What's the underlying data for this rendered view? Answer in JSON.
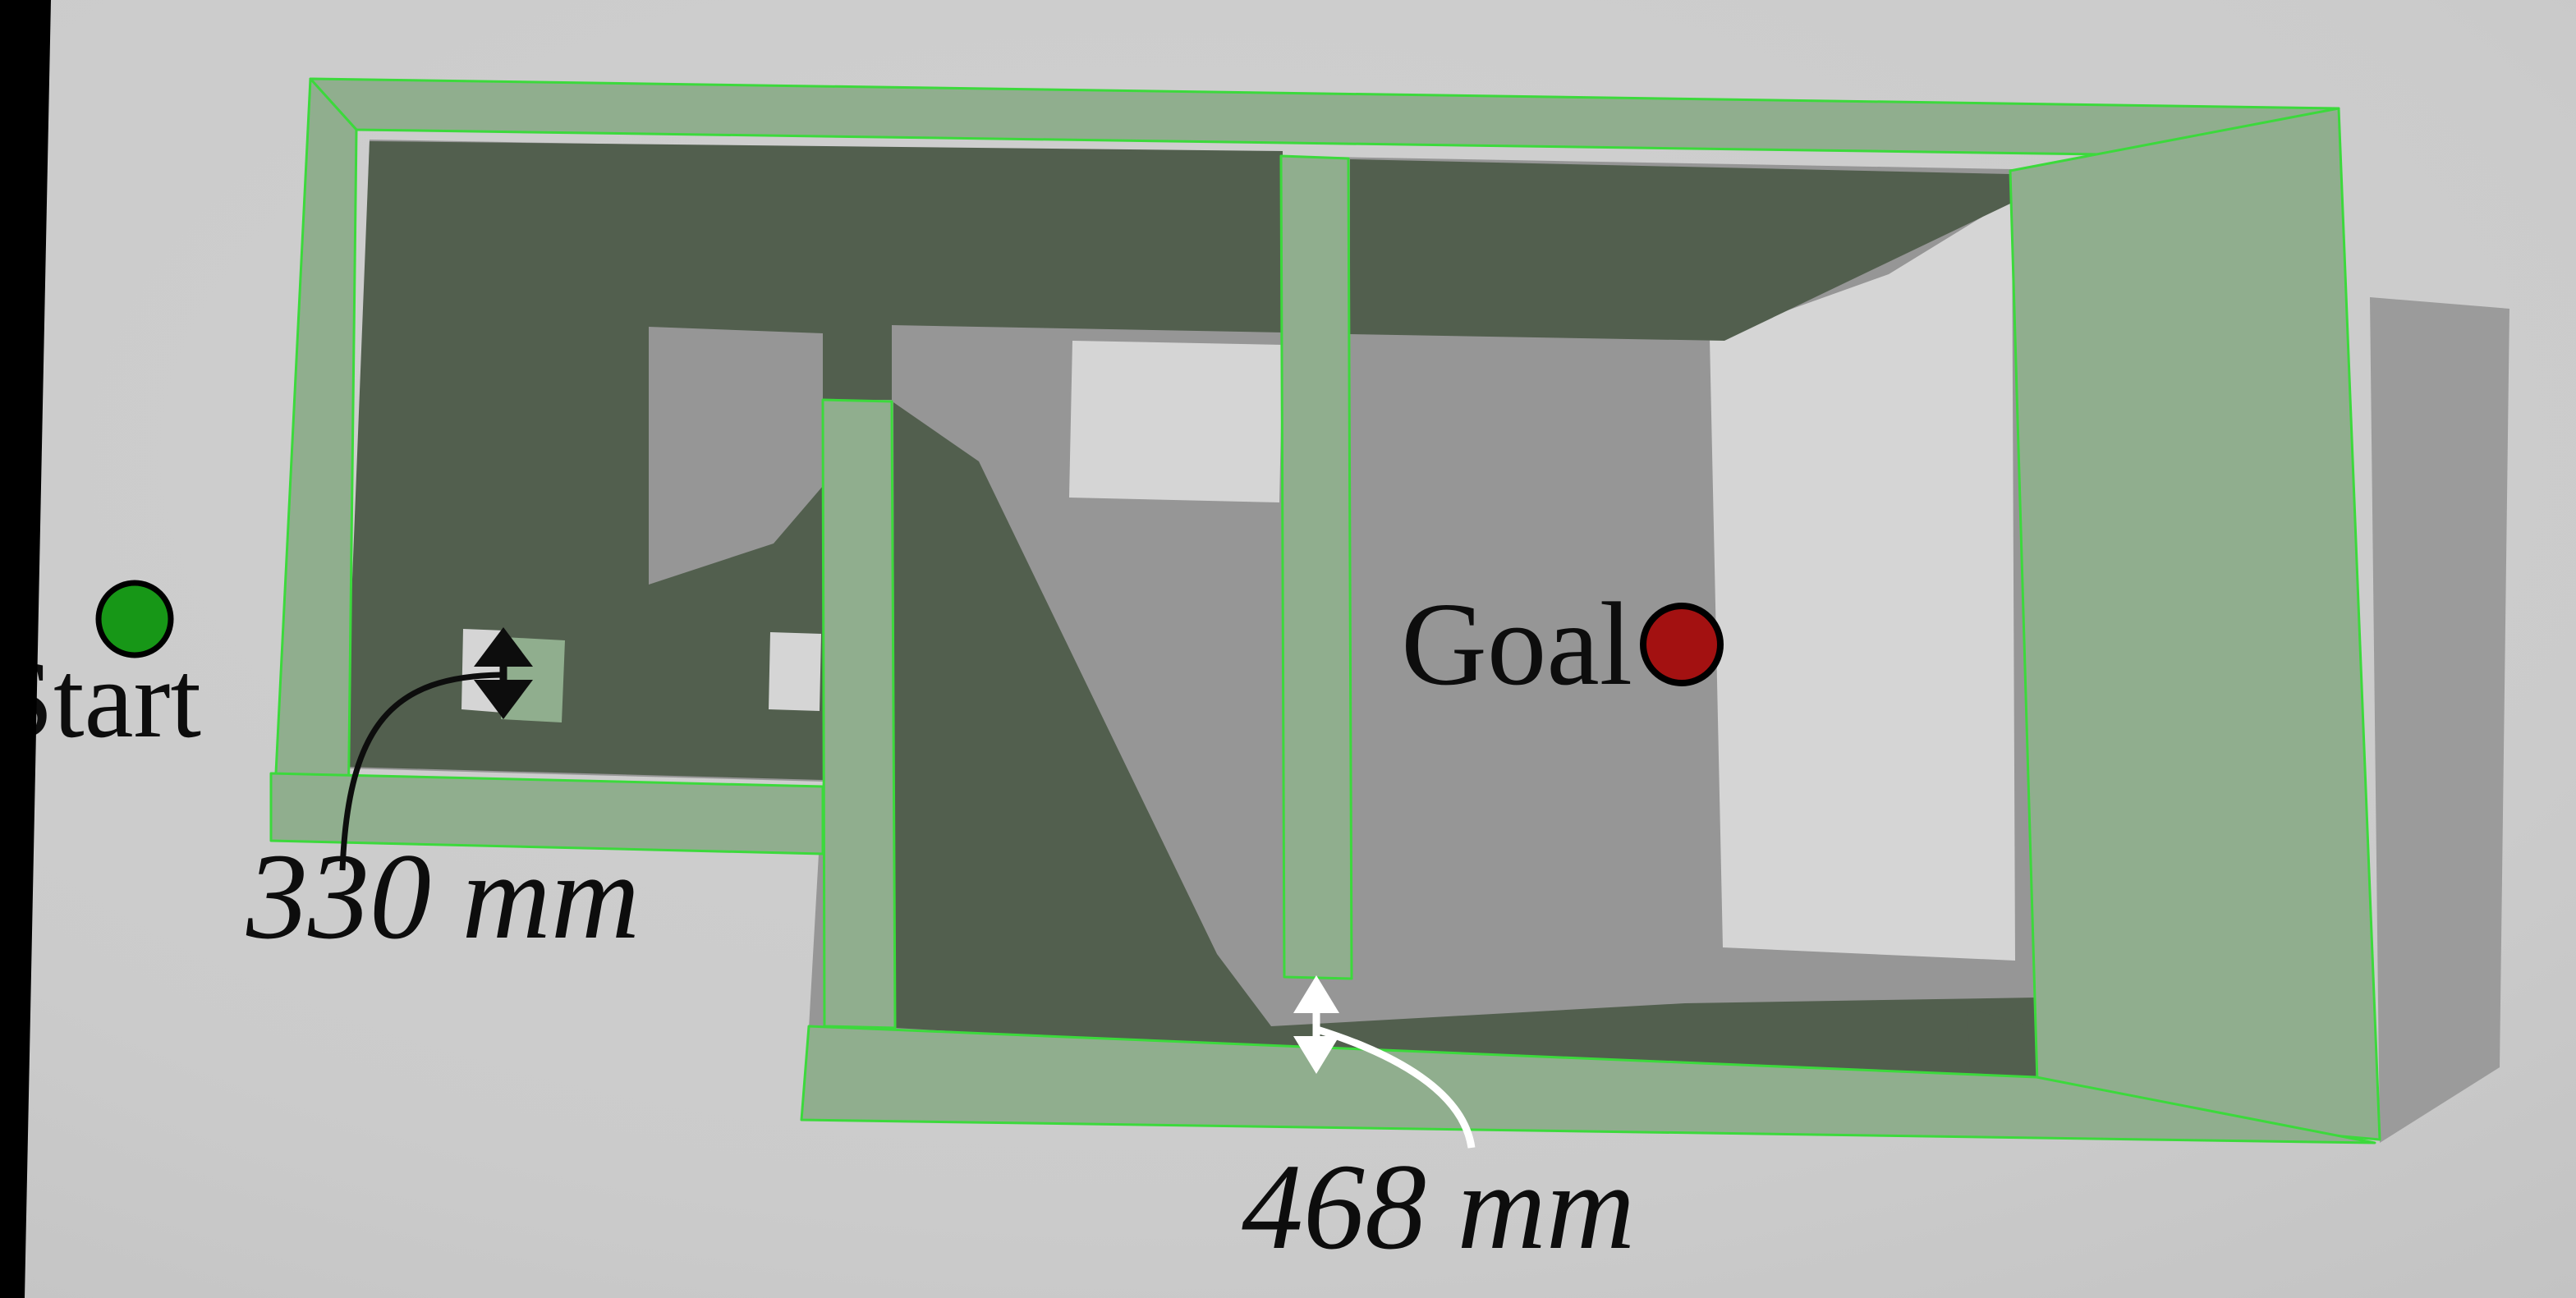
{
  "figure": {
    "description": "Top-down 3D rendered maze environment with start and goal markers and two wall-gap measurements",
    "view": "perspective overhead render"
  },
  "markers": {
    "start": {
      "label": "Start",
      "color": "#179717",
      "outline": "#000000"
    },
    "goal": {
      "label": "Goal",
      "color": "#a31111",
      "outline": "#000000"
    }
  },
  "measurements": {
    "left_gap": {
      "label": "330 mm",
      "annotation_color": "#0d0d0d"
    },
    "bottom_gap": {
      "label": "468 mm",
      "annotation_color": "#ffffff"
    }
  },
  "palette": {
    "background": "#cbcbcb",
    "floor_inside": "#969696",
    "floor_bright": "#d5d5d5",
    "wall_surface": "#90ae8e",
    "wall_edge_highlight": "#3cd93c",
    "shadow_dark": "#525f4e",
    "shadow_outside": "#9b9b9b",
    "left_bar": "#000000"
  }
}
